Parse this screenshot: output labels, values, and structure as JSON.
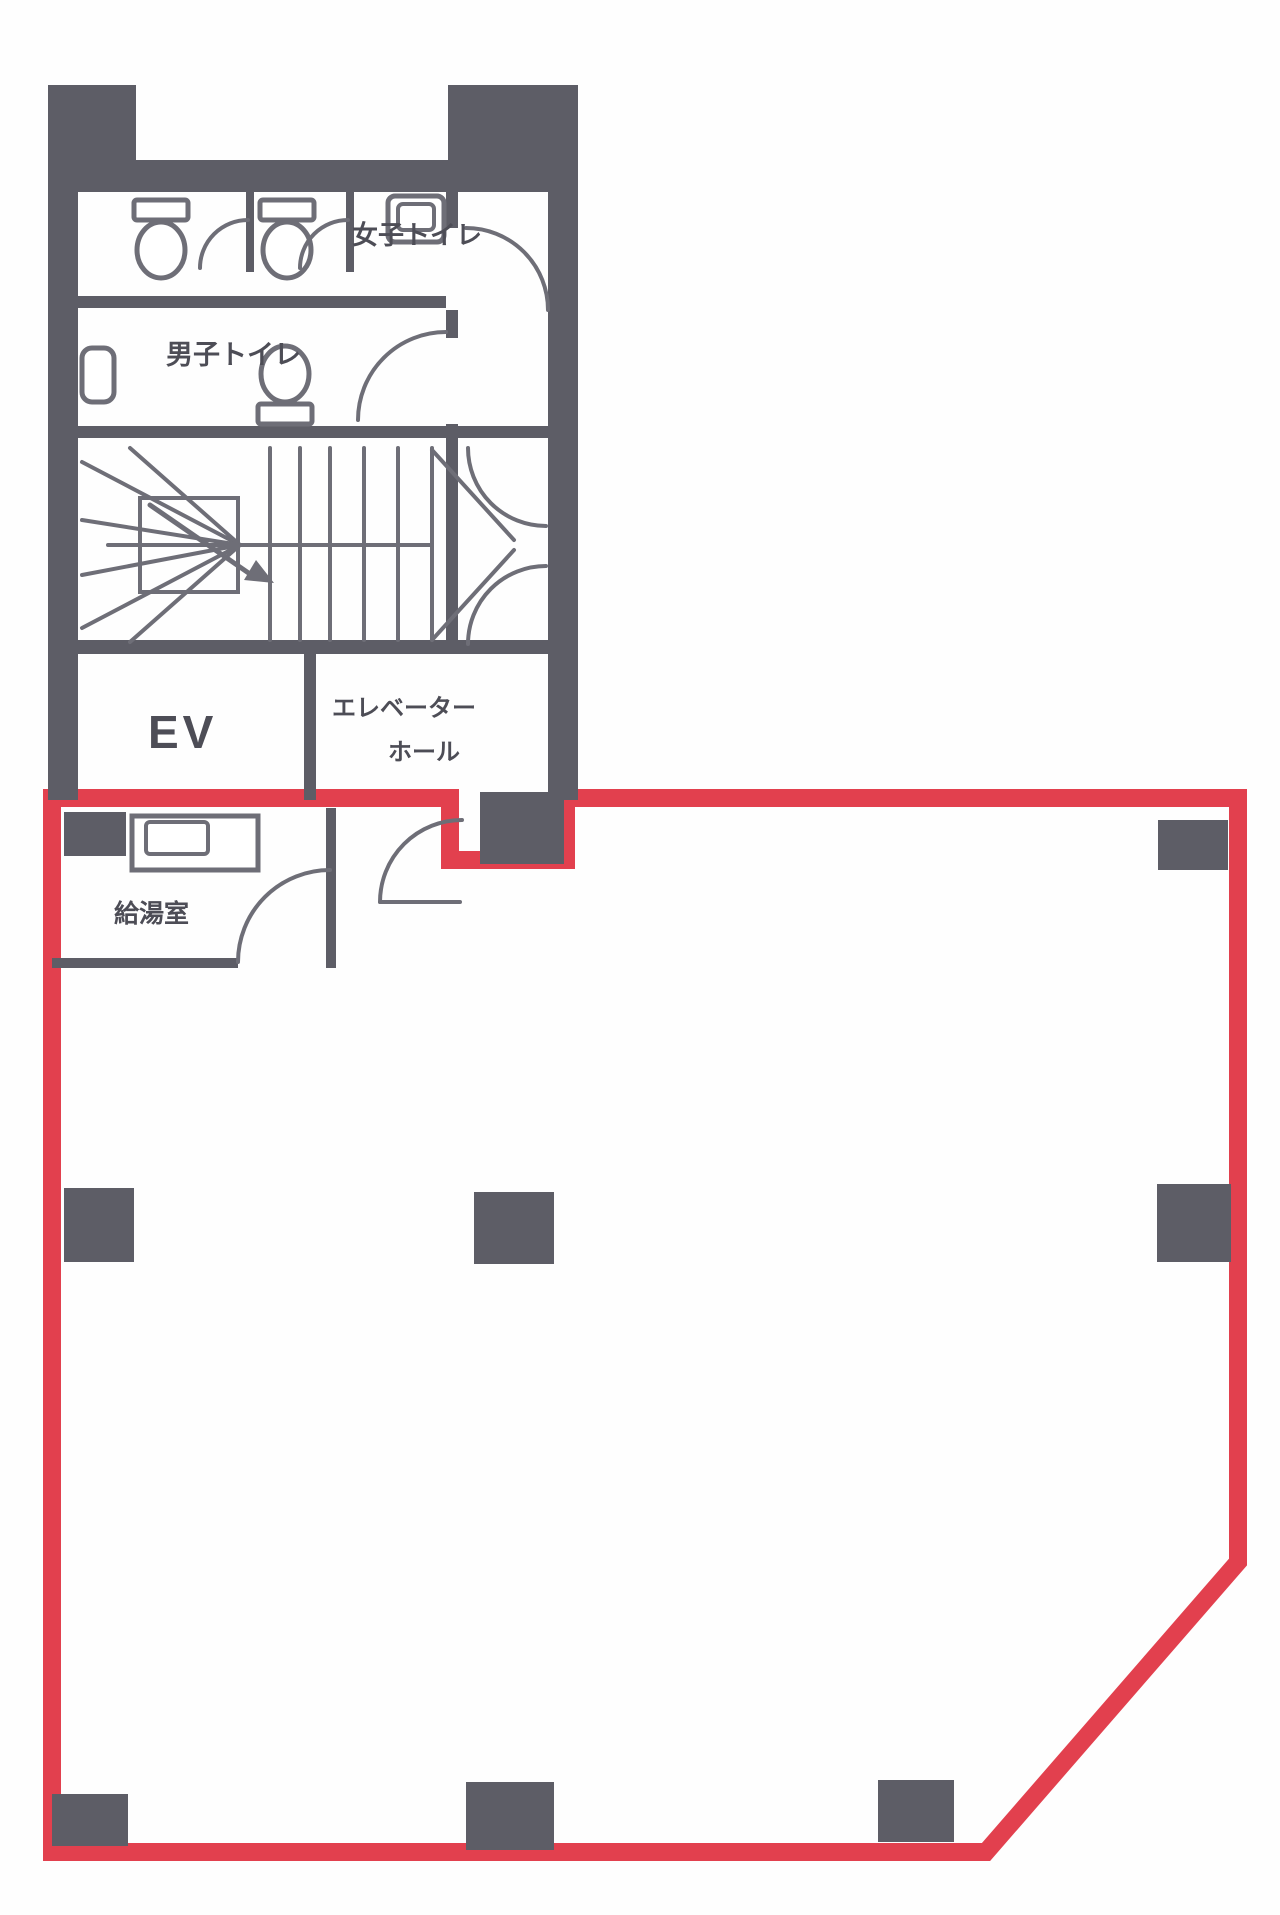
{
  "document": {
    "type": "building-floor-plan",
    "tenant_area_highlight": "red-outline"
  },
  "colors": {
    "wall": "#5d5d66",
    "line": "#6e6e77",
    "red": "#e2404e",
    "text": "#4d4d56",
    "bg": "#fefefe"
  },
  "labels": {
    "womens_toilet": "女子トイレ",
    "mens_toilet": "男子トイレ",
    "elevator": "EV",
    "elevator_hall_line1": "エレベーター",
    "elevator_hall_line2": "ホール",
    "kitchenette": "給湯室"
  }
}
